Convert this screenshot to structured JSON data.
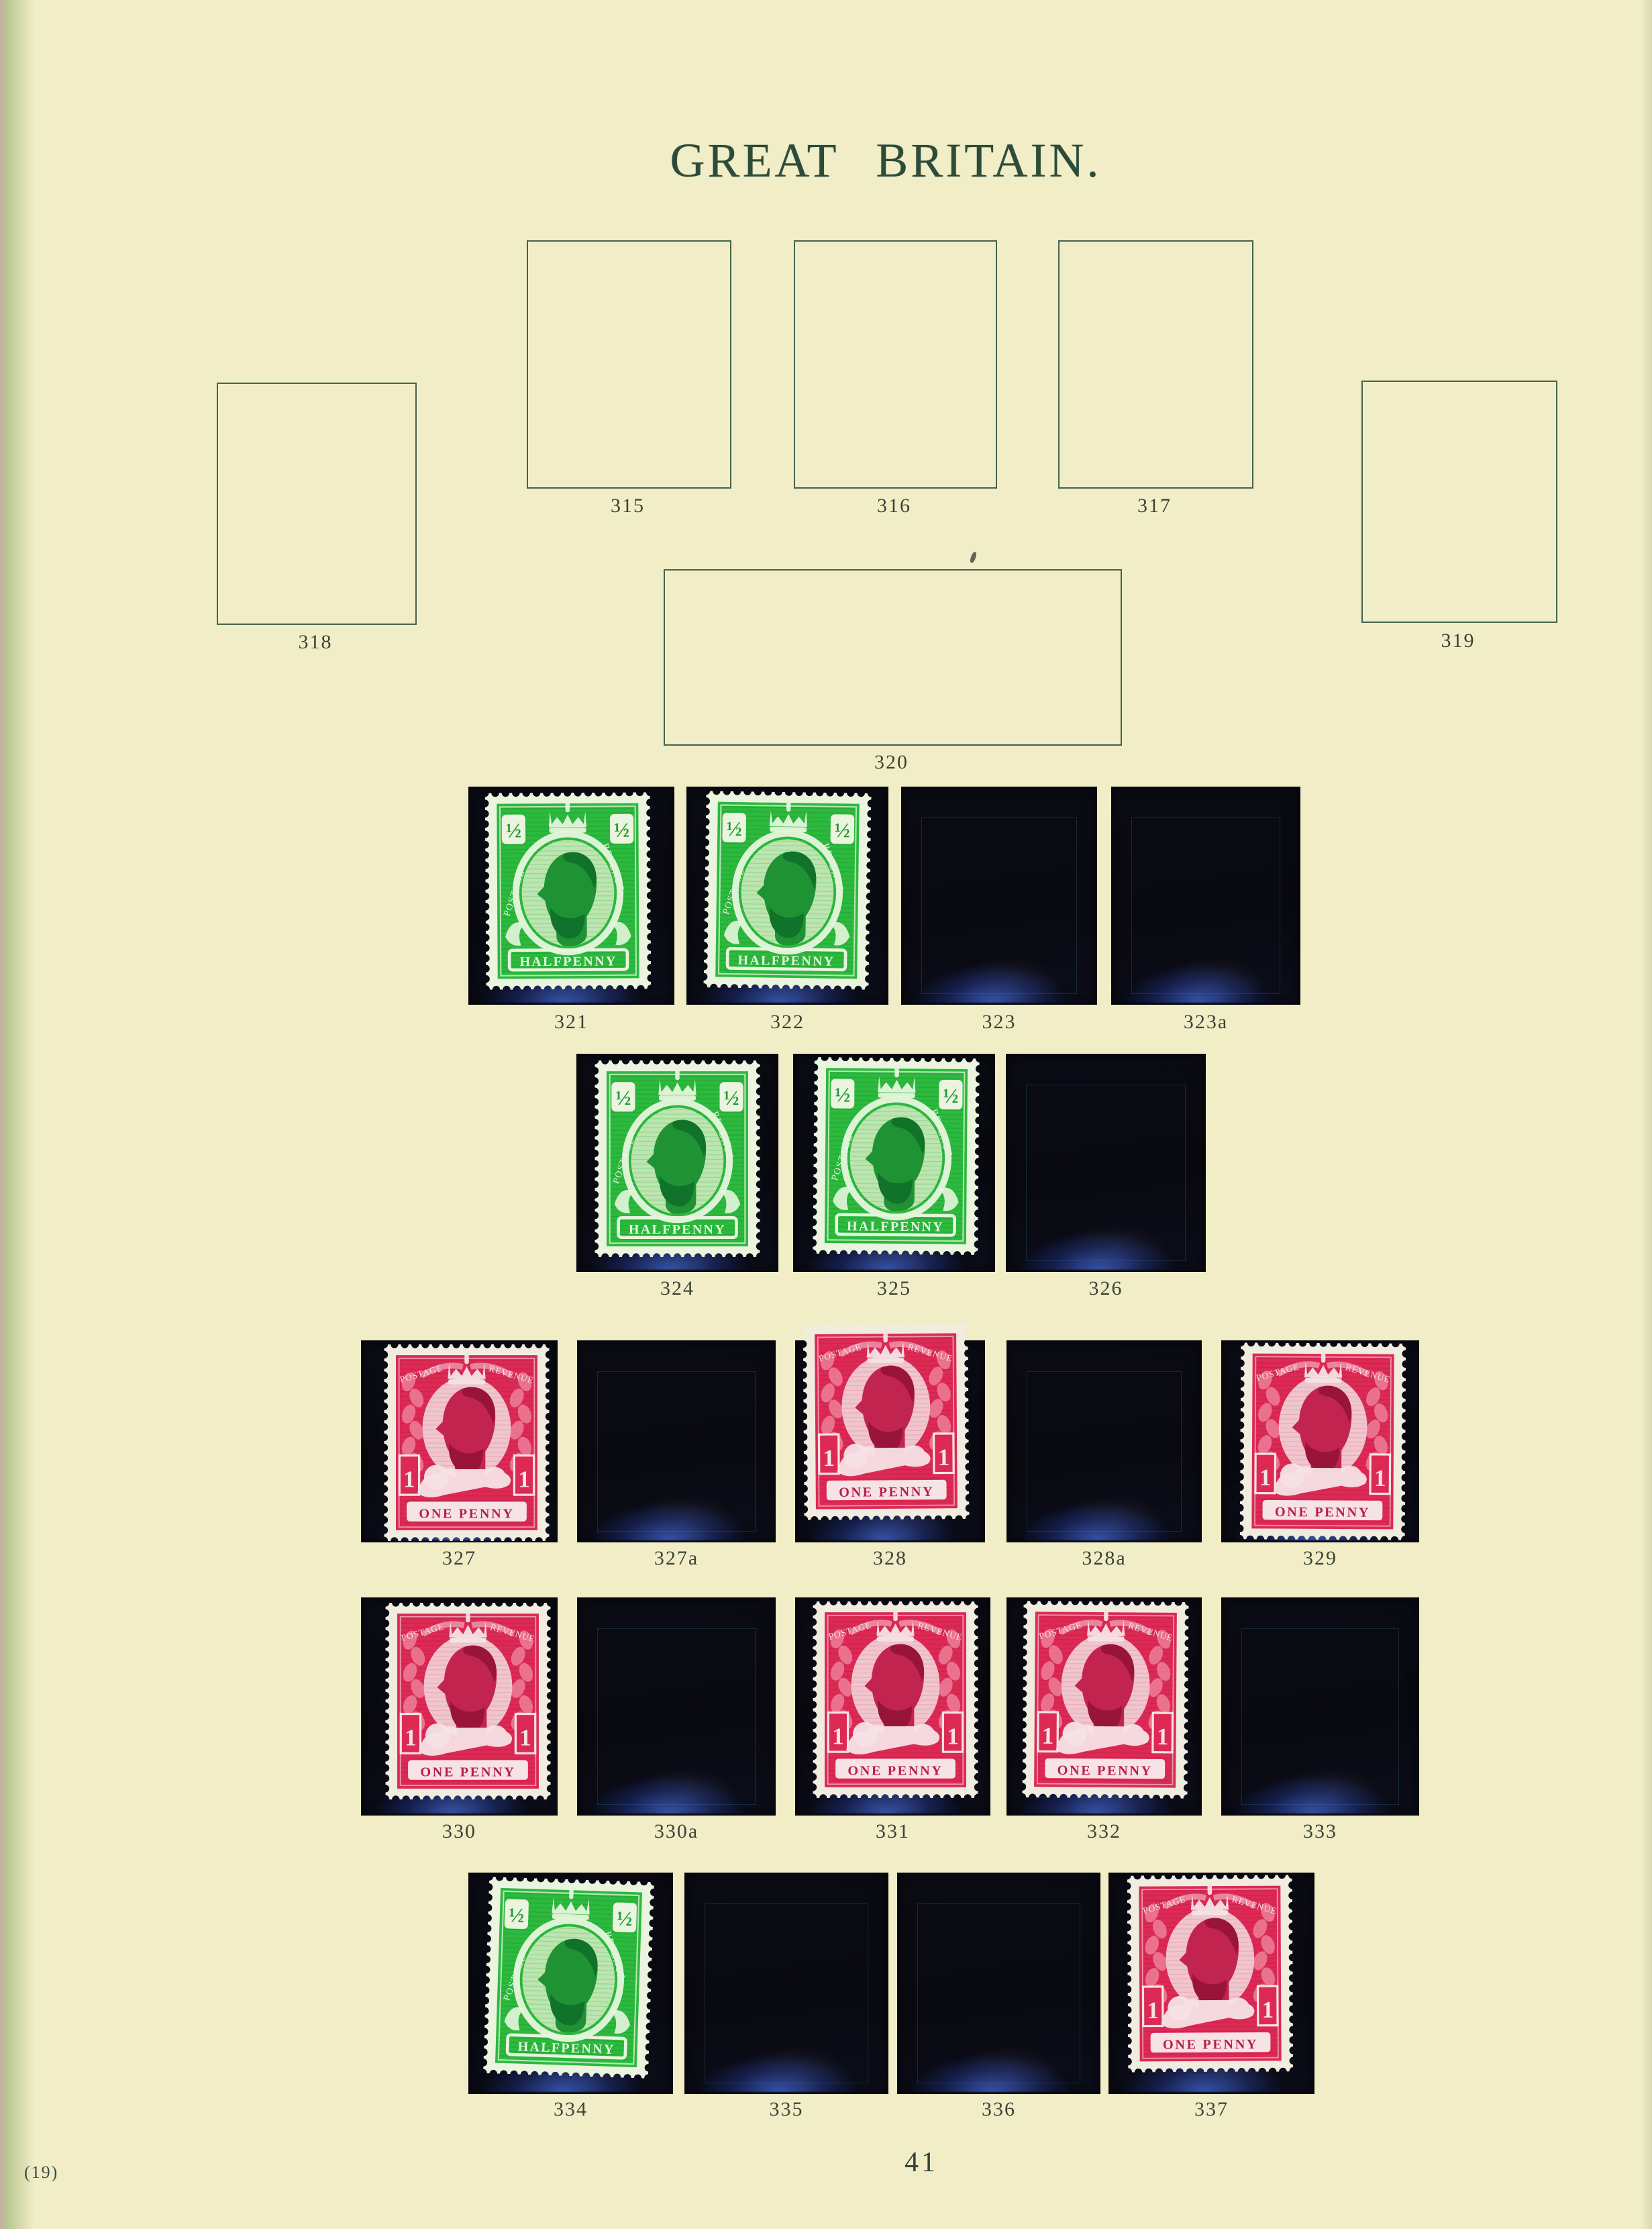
{
  "page": {
    "title": "GREAT BRITAIN.",
    "footer_left": "(19)",
    "page_number": "41"
  },
  "colors": {
    "page_background": "#f1eec7",
    "box_outline": "#45634e",
    "title_ink": "#2c4b3b",
    "label_ink": "#3a4238",
    "mount_black": "#0a0a13",
    "mount_glow_blue": "#507dff",
    "halfpenny_green": "#2cb93e",
    "penny_carmine": "#dc2a55"
  },
  "empty_boxes": [
    {
      "number": "315"
    },
    {
      "number": "316"
    },
    {
      "number": "317"
    },
    {
      "number": "318"
    },
    {
      "number": "319"
    },
    {
      "number": "320"
    }
  ],
  "mount_rows": [
    {
      "mounts": [
        {
          "number": "321",
          "stamp": "halfpenny"
        },
        {
          "number": "322",
          "stamp": "halfpenny"
        },
        {
          "number": "323",
          "stamp": ""
        },
        {
          "number": "323a",
          "stamp": ""
        }
      ]
    },
    {
      "mounts": [
        {
          "number": "324",
          "stamp": "halfpenny"
        },
        {
          "number": "325",
          "stamp": "halfpenny"
        },
        {
          "number": "326",
          "stamp": ""
        }
      ]
    },
    {
      "mounts": [
        {
          "number": "327",
          "stamp": "penny"
        },
        {
          "number": "327a",
          "stamp": ""
        },
        {
          "number": "328",
          "stamp": "penny"
        },
        {
          "number": "328a",
          "stamp": ""
        },
        {
          "number": "329",
          "stamp": "penny"
        }
      ]
    },
    {
      "mounts": [
        {
          "number": "330",
          "stamp": "penny"
        },
        {
          "number": "330a",
          "stamp": ""
        },
        {
          "number": "331",
          "stamp": "penny"
        },
        {
          "number": "332",
          "stamp": "penny"
        },
        {
          "number": "333",
          "stamp": ""
        }
      ]
    },
    {
      "mounts": [
        {
          "number": "334",
          "stamp": "halfpenny"
        },
        {
          "number": "335",
          "stamp": ""
        },
        {
          "number": "336",
          "stamp": ""
        },
        {
          "number": "337",
          "stamp": "penny"
        }
      ]
    }
  ],
  "stamp_designs": {
    "halfpenny": {
      "value": "½",
      "banner": "HALFPENNY",
      "left_label": "POSTAGE",
      "right_label": "REVENUE",
      "ink": "#2cb93e",
      "ink_dark": "#1d9a31",
      "portrait": "#1f9233",
      "portrait_dark": "#11722a",
      "oval": "#bce5b0",
      "paper": "#eaf4de",
      "pale": "#e6f6dd"
    },
    "penny": {
      "value": "1",
      "banner": "ONE PENNY",
      "left_label": "POSTAGE",
      "right_label": "REVENUE",
      "ink": "#dc2a55",
      "ink_dark": "#bb1d46",
      "portrait": "#c22450",
      "portrait_dark": "#991439",
      "oval": "#f0c6ce",
      "paper": "#f0ece0",
      "pale": "#f5e3e6"
    }
  }
}
